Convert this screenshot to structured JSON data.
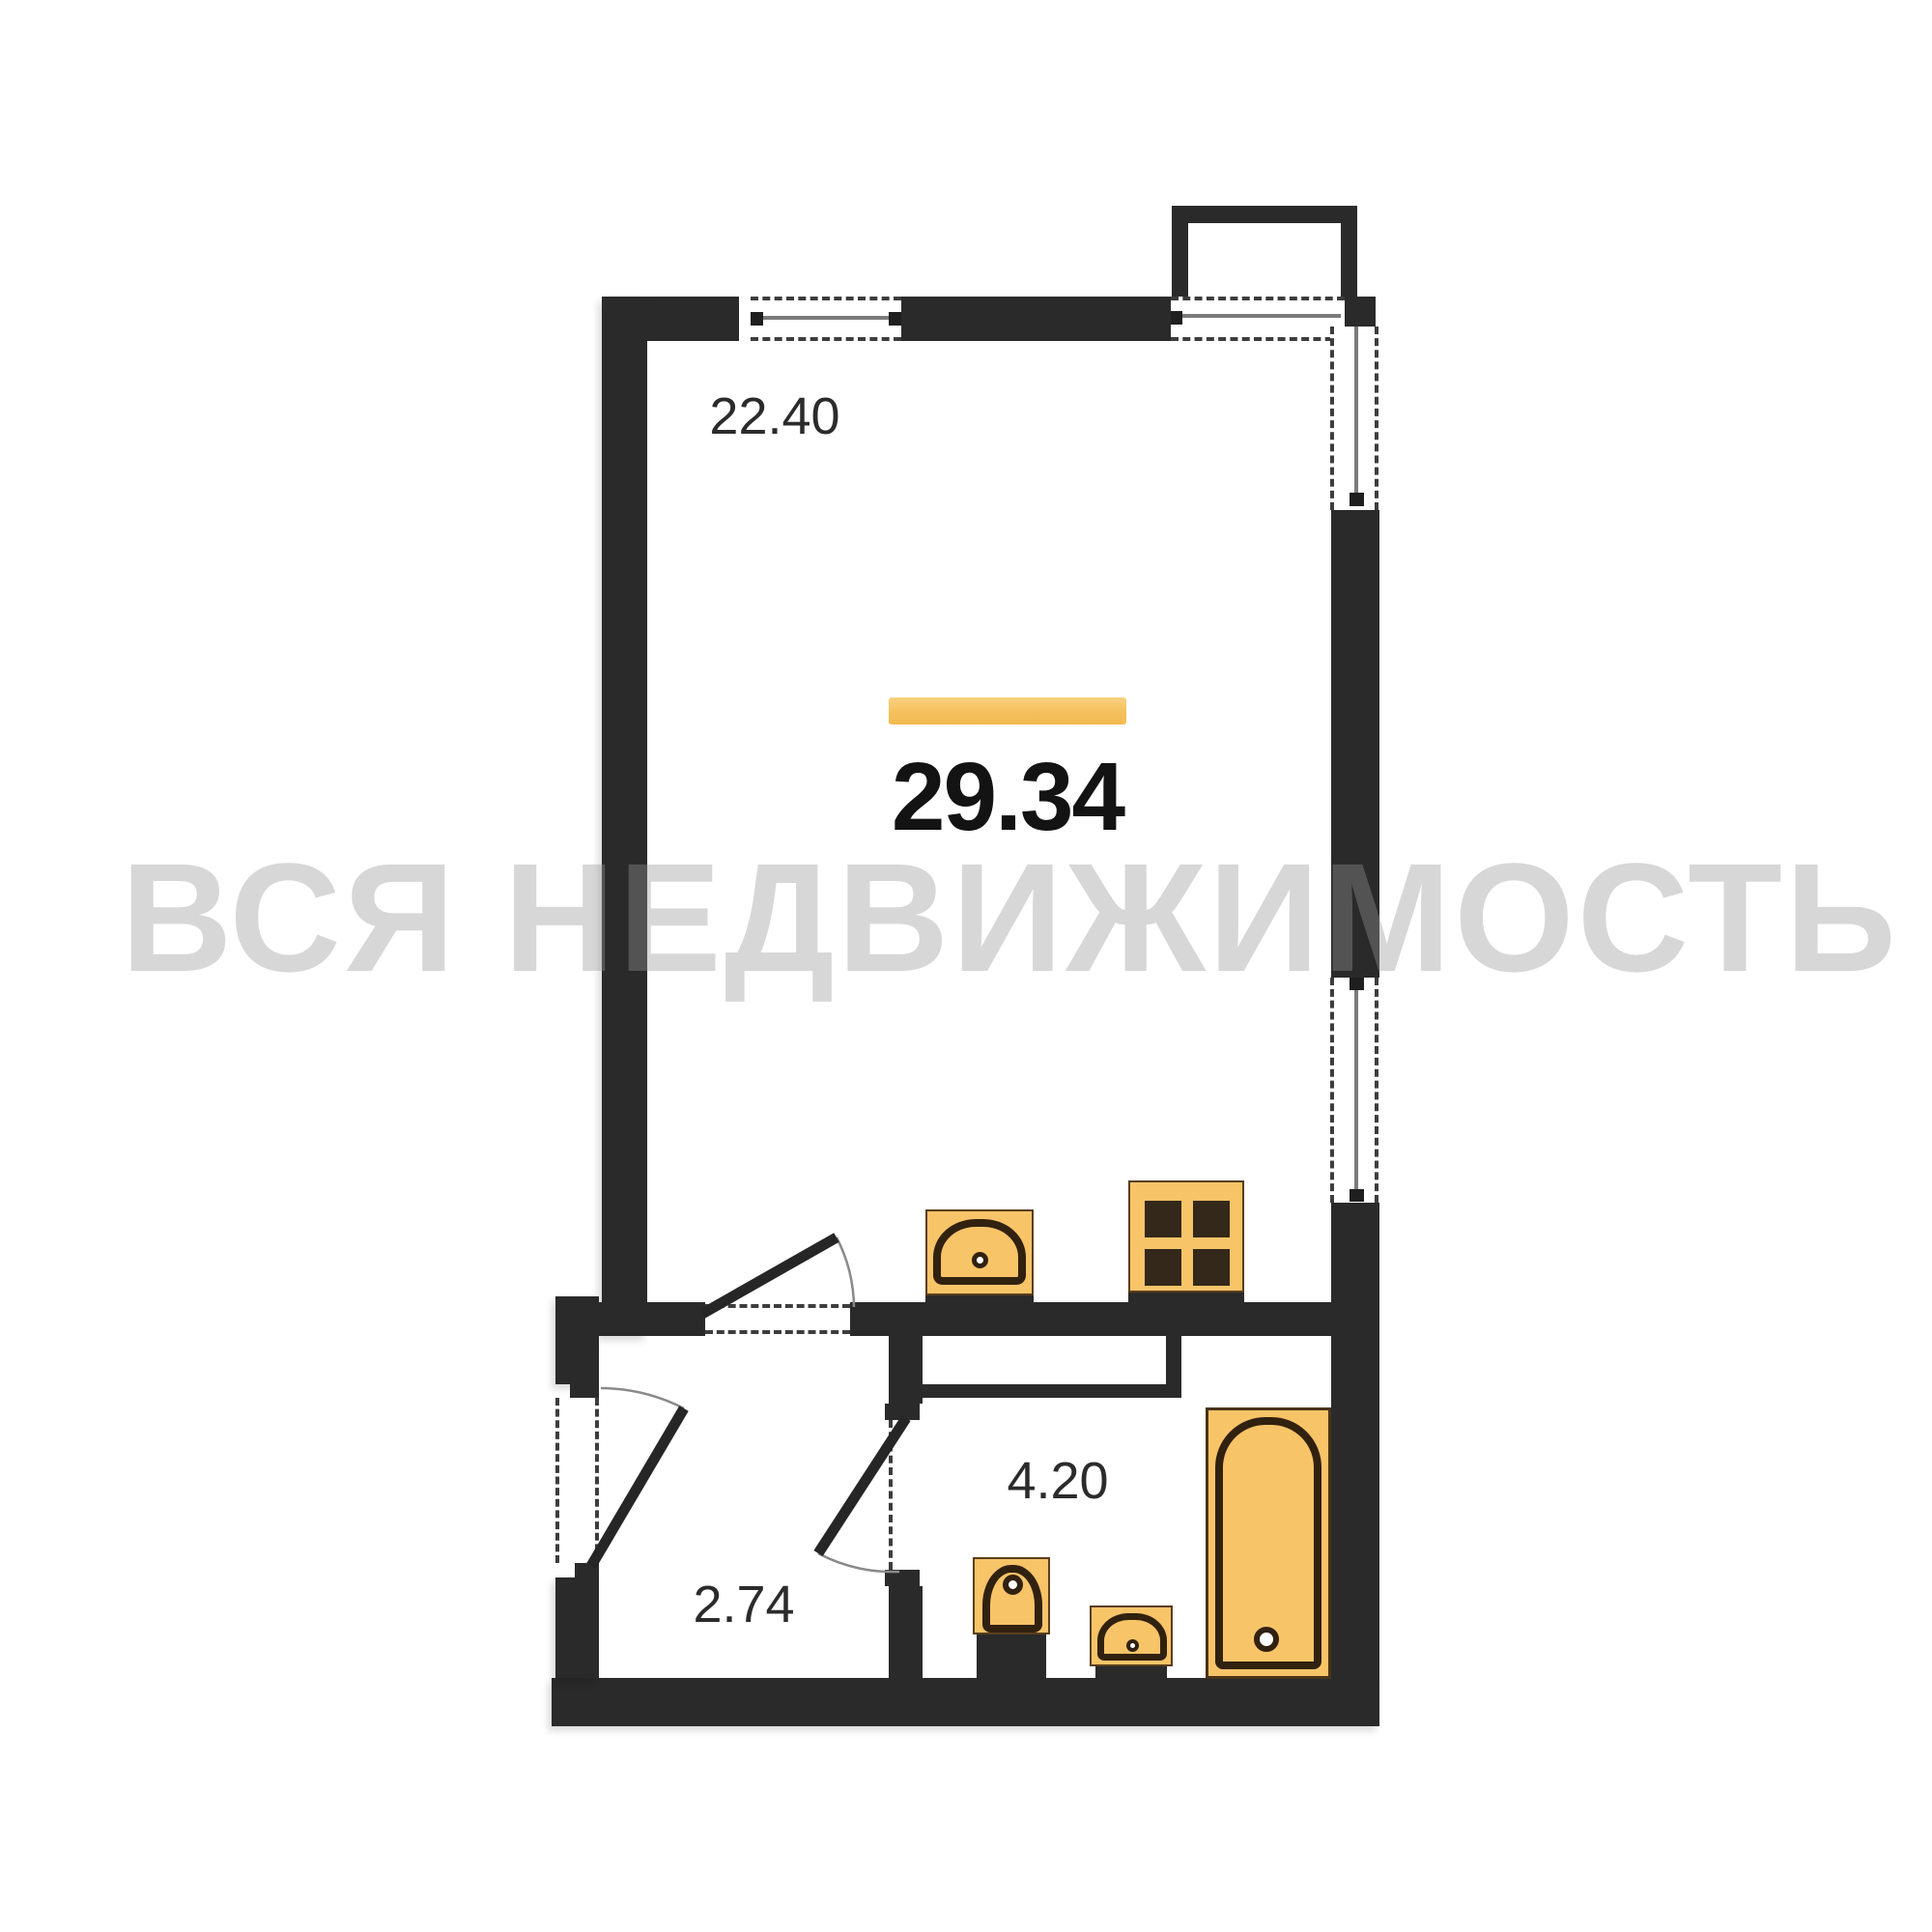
{
  "plan": {
    "watermark": "ВСЯ НЕДВИЖИМОСТЬ",
    "total": {
      "area": "29.34"
    },
    "rooms": [
      {
        "id": "living-room",
        "area": "22.40"
      },
      {
        "id": "bathroom",
        "area": "4.20"
      },
      {
        "id": "hallway",
        "area": "2.74"
      }
    ],
    "fixtures": [
      "balcony",
      "corner-window",
      "top-window",
      "side-window",
      "kitchen-sink",
      "stove",
      "toilet",
      "washbasin",
      "bathtub",
      "entry-door",
      "room-door",
      "bathroom-door"
    ],
    "colors": {
      "wall": "#2a2a2a",
      "fixture-fill": "#f8c468",
      "fixture-outline": "#31210f",
      "accent-bar": "#f5c05c",
      "label": "#2b2b2b",
      "watermark": "rgba(150,150,150,0.38)"
    }
  }
}
